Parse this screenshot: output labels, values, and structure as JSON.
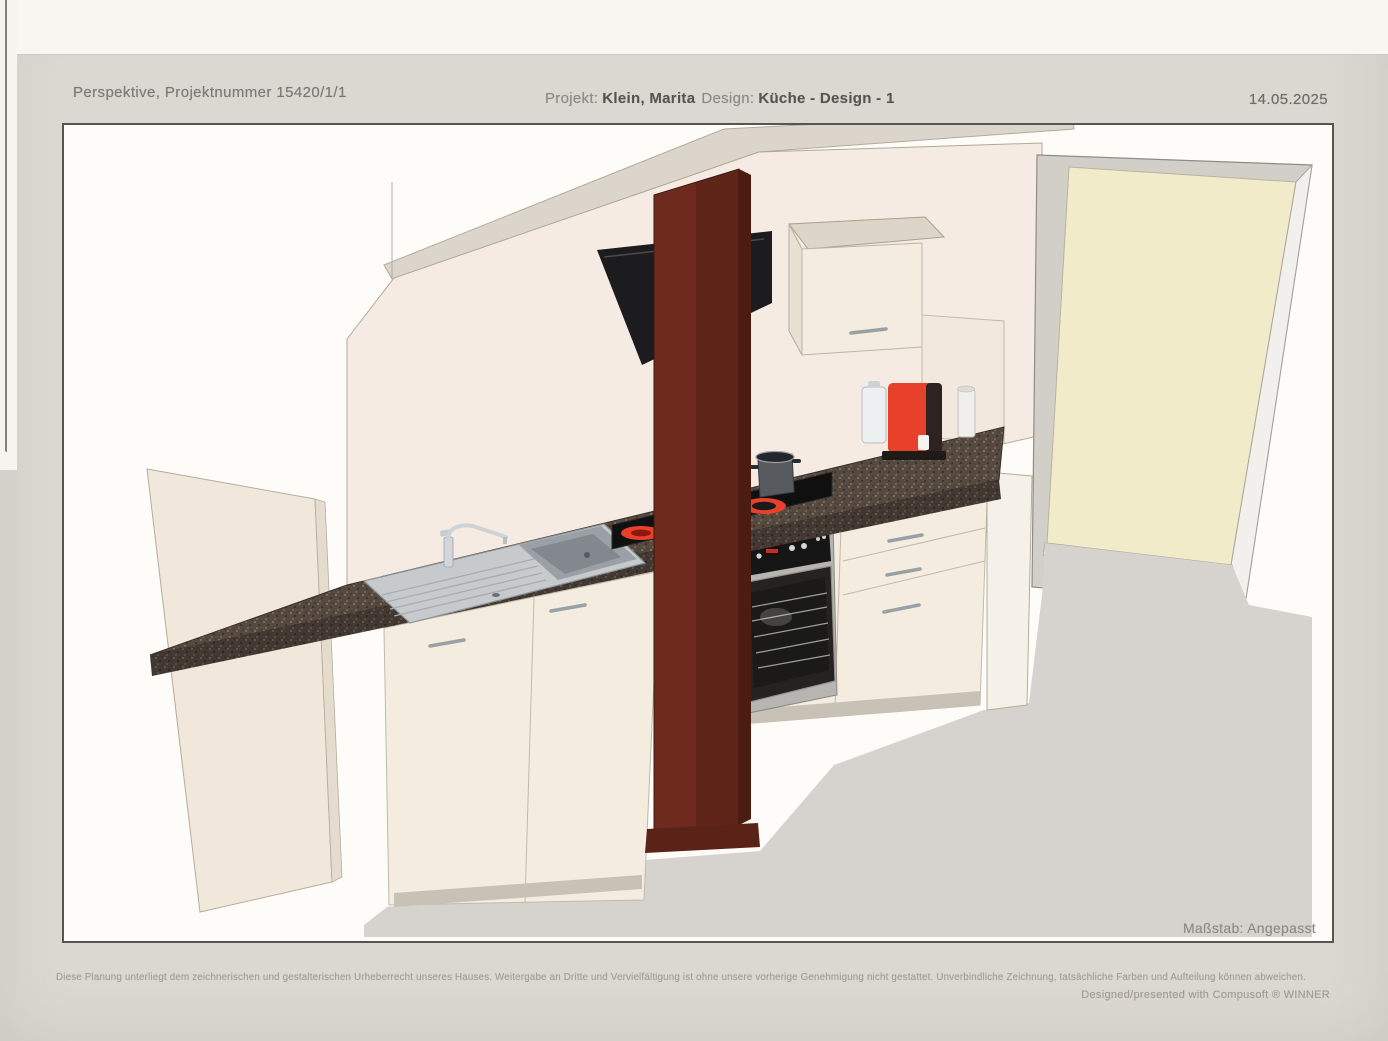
{
  "header": {
    "title": "Perspektive, Projektnummer 15420/1/1",
    "project_label": "Projekt:",
    "project_value": "Klein, Marita",
    "design_label": "Design:",
    "design_value": "Küche - Design - 1",
    "date": "14.05.2025"
  },
  "drawing": {
    "scale_note": "Maßstab: Angepasst",
    "objects": [
      "sloped attic ceiling",
      "back wall",
      "wall cabinet",
      "cooker hood",
      "support pillar",
      "granite countertop",
      "sink with drainer",
      "mixer tap",
      "ceramic hob with pot",
      "built-in oven",
      "sink base cabinet",
      "drawer unit",
      "end panel",
      "coffee machine",
      "door",
      "floor"
    ],
    "colors": {
      "back_wall": "#f6ebe2",
      "ceiling_slope": "#dbd5cc",
      "side_panel": "#f1e7da",
      "cabinet_front": "#f4ecdf",
      "cabinet_top": "#ddd5c8",
      "countertop": "#564a40",
      "pillar_front": "#6e2b1d",
      "pillar_side": "#4d1c11",
      "hood": "#1c1b1d",
      "accent_red": "#e7402b",
      "stainless": "#c6cacd",
      "oven_body": "#b7b5b1",
      "oven_dark": "#242321",
      "door_panel": "#f1ebc9",
      "door_jamb": "#d2cfc8",
      "floor": "#d6d3cf",
      "toe_kick": "#c8c1b6"
    }
  },
  "footer": {
    "disclaimer": "Diese Planung unterliegt dem zeichnerischen und gestalterischen Urheberrecht unseres Hauses. Weitergabe an Dritte und Vervielfältigung ist ohne unsere vorherige Genehmigung nicht gestattet. Unverbindliche Zeichnung, tatsächliche Farben und Aufteilung können abweichen.",
    "credit": "Designed/presented with Compusoft ® WINNER"
  }
}
